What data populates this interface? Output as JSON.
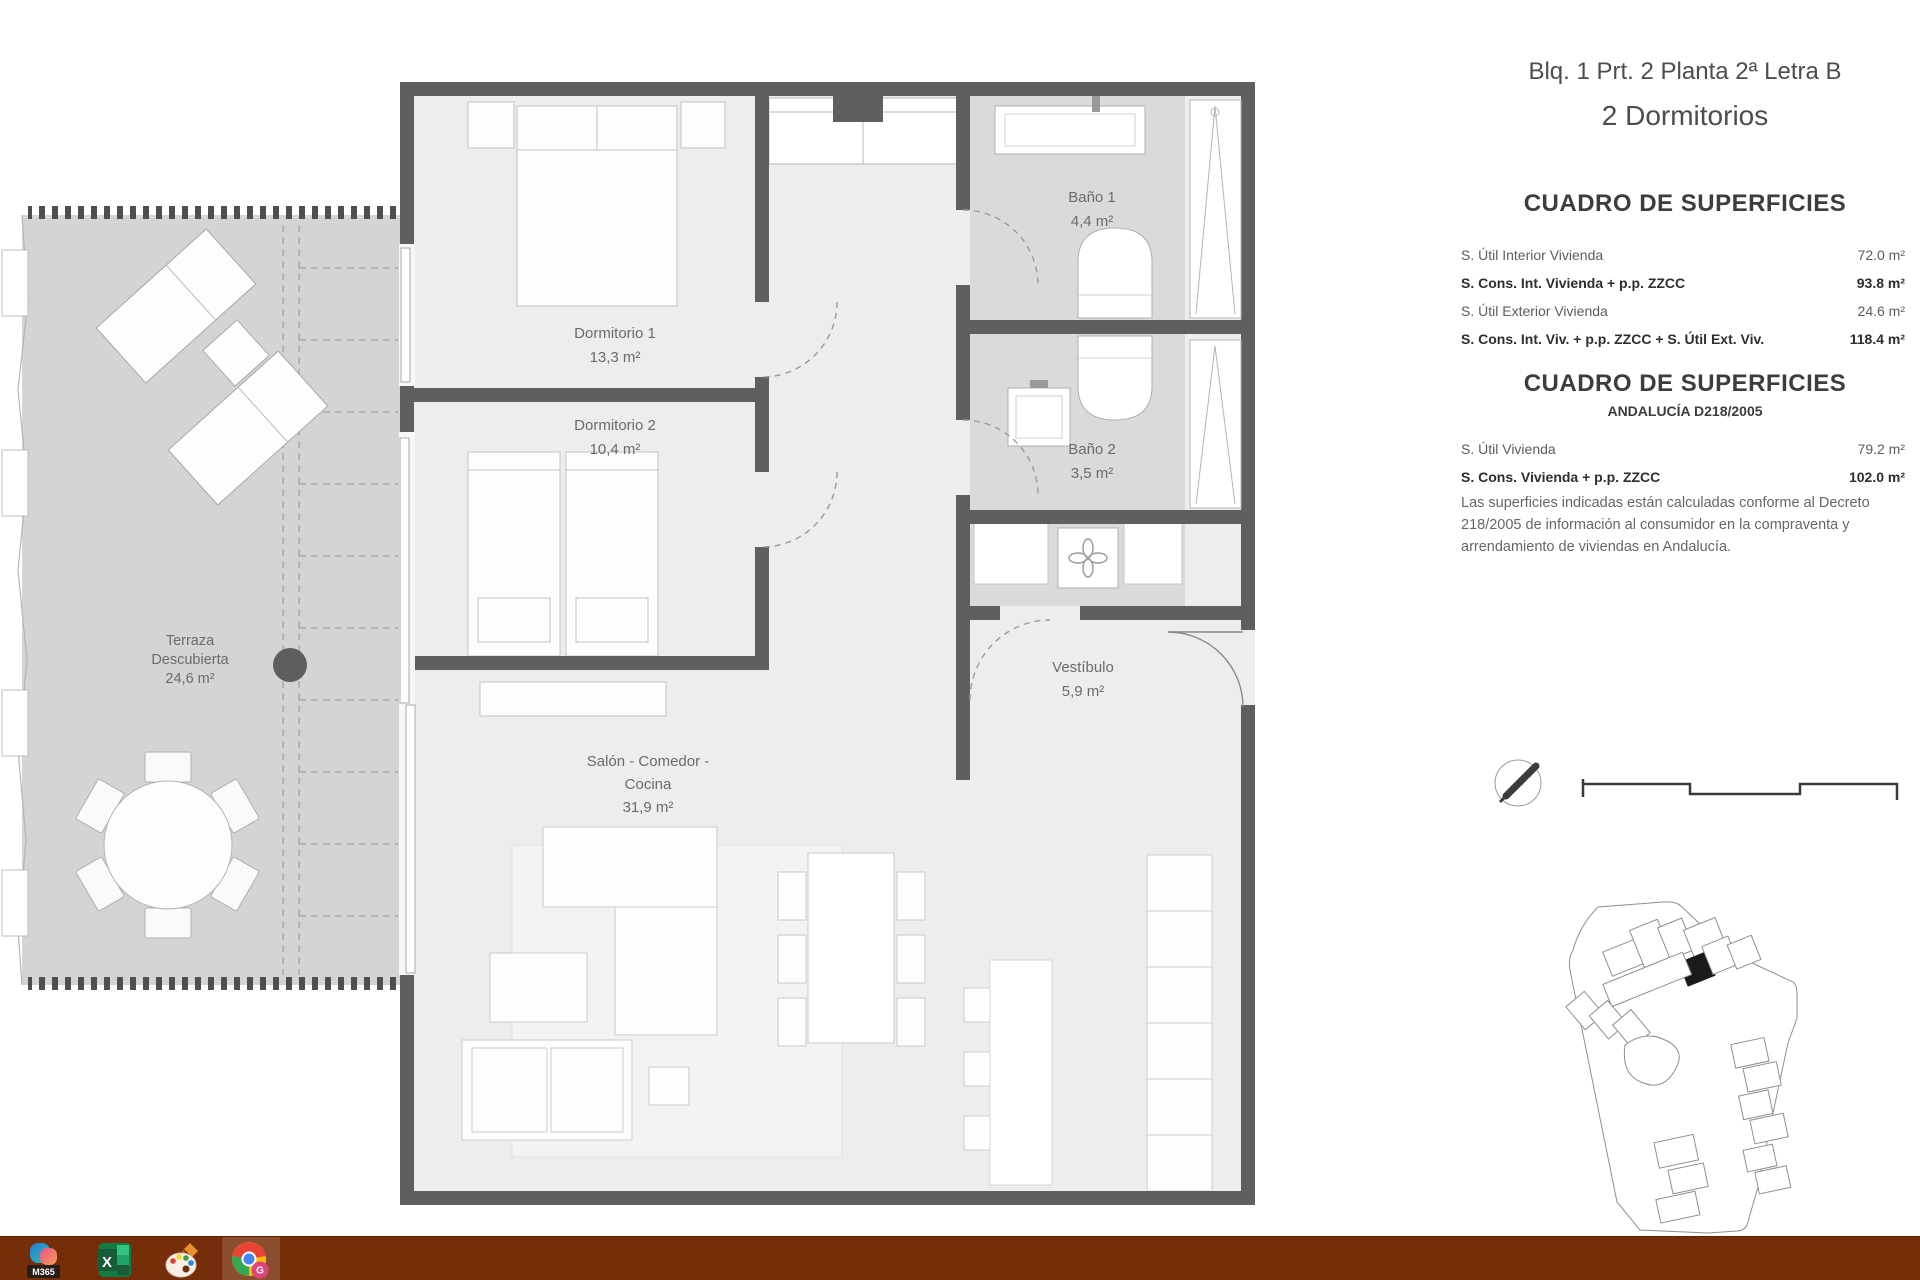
{
  "header": {
    "title": "Blq. 1 Prt. 2 Planta 2ª Letra B",
    "subtitle": "2 Dormitorios"
  },
  "surfaces_main": {
    "heading": "CUADRO DE SUPERFICIES",
    "rows": [
      {
        "label": "S. Útil Interior Vivienda",
        "value": "72.0 m²"
      },
      {
        "label": "S. Cons. Int. Vivienda + p.p. ZZCC",
        "value": "93.8 m²"
      },
      {
        "label": "S. Útil Exterior Vivienda",
        "value": "24.6 m²"
      },
      {
        "label": "S. Cons. Int. Viv. + p.p. ZZCC + S. Útil Ext. Viv.",
        "value": "118.4 m²"
      }
    ]
  },
  "surfaces_andalucia": {
    "heading": "CUADRO DE SUPERFICIES",
    "subheading": "ANDALUCÍA D218/2005",
    "rows": [
      {
        "label": "S. Útil Vivienda",
        "value": "79.2 m²"
      },
      {
        "label": "S. Cons. Vivienda + p.p. ZZCC",
        "value": "102.0 m²"
      }
    ],
    "disclaimer": "Las superficies indicadas están calculadas conforme al Decreto 218/2005 de información al consumidor en la compraventa y arrendamiento de viviendas en Andalucía."
  },
  "floorplan": {
    "rooms": {
      "dormitorio1": {
        "name": "Dormitorio 1",
        "area": "13,3 m²"
      },
      "dormitorio2": {
        "name": "Dormitorio 2",
        "area": "10,4 m²"
      },
      "bano1": {
        "name": "Baño 1",
        "area": "4,4 m²"
      },
      "bano2": {
        "name": "Baño 2",
        "area": "3,5 m²"
      },
      "vestibulo": {
        "name": "Vestíbulo",
        "area": "5,9 m²"
      },
      "salon": {
        "name_line1": "Salón - Comedor -",
        "name_line2": "Cocina",
        "area": "31,9 m²"
      },
      "terraza": {
        "name_line1": "Terraza",
        "name_line2": "Descubierta",
        "area": "24,6 m²"
      }
    }
  },
  "taskbar": {
    "m365_badge": "M365",
    "chrome_badge": "G"
  },
  "colors": {
    "wall": "#5f5f5f",
    "floor": "#ededed",
    "bathroom_floor": "#dadada",
    "terrace_floor": "#d4d4d4",
    "taskbar": "#752d0a"
  }
}
